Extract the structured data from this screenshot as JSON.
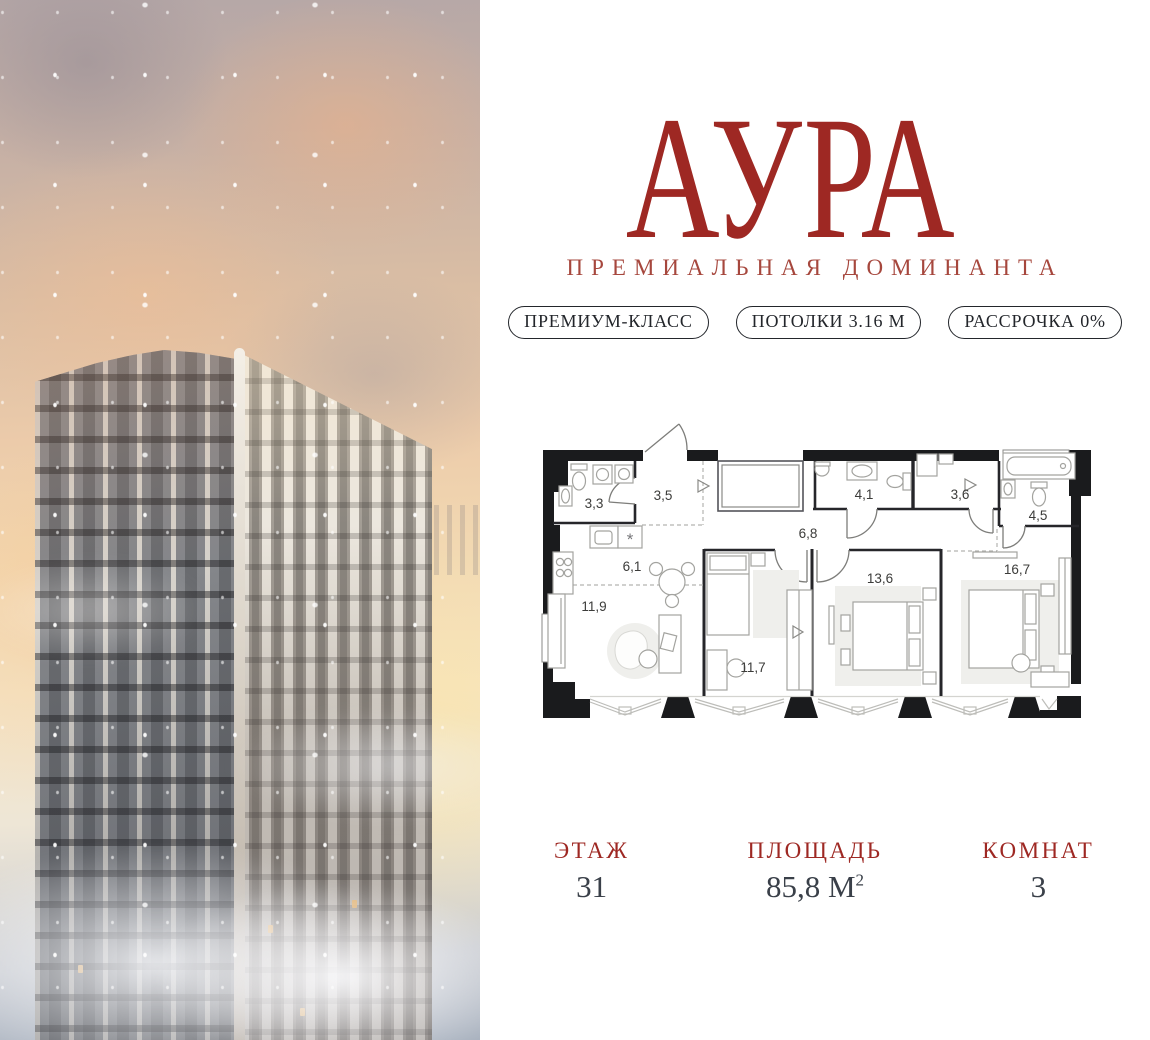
{
  "brand": {
    "logo": "АУРА",
    "tagline": "ПРЕМИАЛЬНАЯ ДОМИНАНТА"
  },
  "badges": [
    {
      "label": "ПРЕМИУМ-КЛАСС"
    },
    {
      "label": "ПОТОЛКИ 3.16 М"
    },
    {
      "label": "РАССРОЧКА 0%"
    }
  ],
  "floor_plan": {
    "rooms": [
      {
        "area": "3,3"
      },
      {
        "area": "3,5"
      },
      {
        "area": "4,1"
      },
      {
        "area": "3,6"
      },
      {
        "area": "4,5"
      },
      {
        "area": "6,8"
      },
      {
        "area": "6,1"
      },
      {
        "area": "13,6"
      },
      {
        "area": "16,7"
      },
      {
        "area": "11,9"
      },
      {
        "area": "11,7"
      }
    ],
    "kitchen_symbol": "*"
  },
  "info": [
    {
      "label": "ЭТАЖ",
      "value": "31",
      "sup": ""
    },
    {
      "label": "ПЛОЩАДЬ",
      "value": "85,8 М",
      "sup": "2"
    },
    {
      "label": "КОМНАТ",
      "value": "3",
      "sup": ""
    }
  ],
  "colors": {
    "accent_red": "#9E2823",
    "tagline_red": "#A6473D",
    "value_ink": "#3A4049",
    "wall_ink": "#1a1b1d"
  }
}
